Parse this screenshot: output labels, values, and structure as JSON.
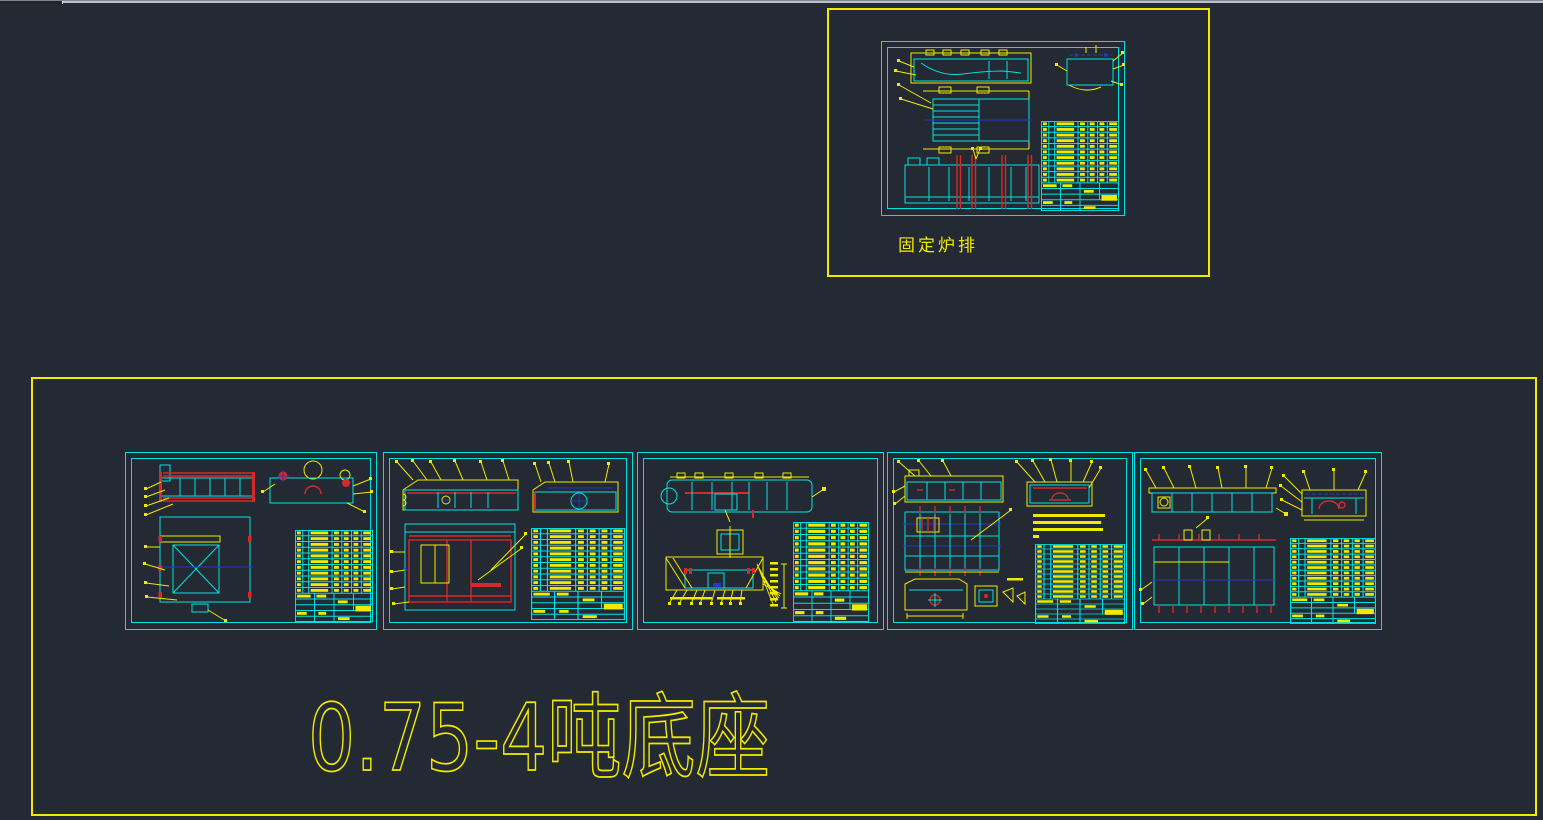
{
  "colors": {
    "bg": "#232a33",
    "yellow": "#f2e900",
    "cyan": "#00e2e2",
    "red": "#d42a2a",
    "blue": "#2336cc",
    "tab-light": "#b9c0c8",
    "tab-dark": "#20262e"
  },
  "top_panel": {
    "label": "固定炉排"
  },
  "bottom_panel": {
    "label": "0.75-4吨底座"
  }
}
